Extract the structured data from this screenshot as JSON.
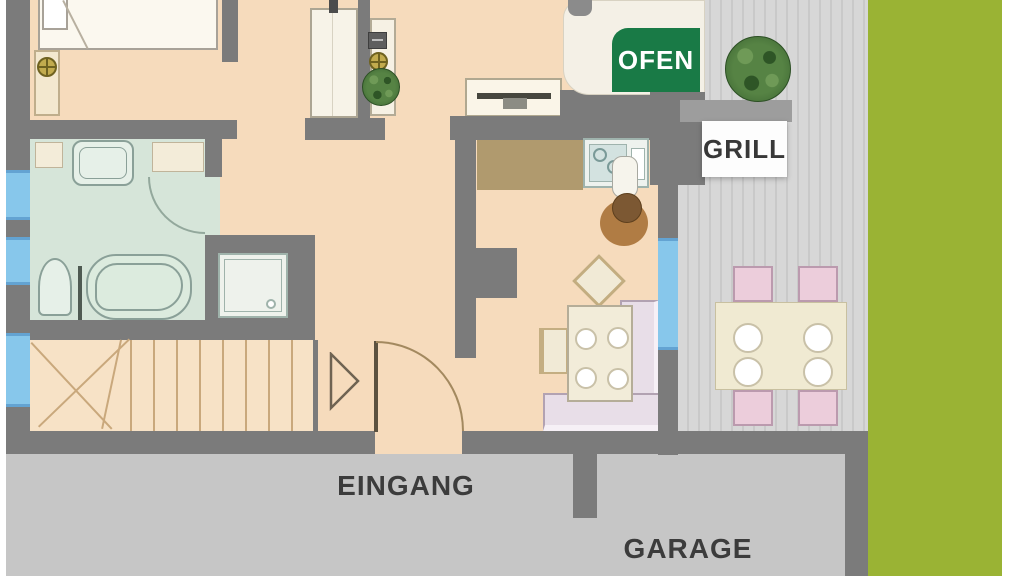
{
  "plan": {
    "type": "floor-plan",
    "labels": {
      "oven": "OFEN",
      "grill": "GRILL",
      "entrance": "EINGANG",
      "garage": "GARAGE"
    },
    "colors": {
      "wall": "#7b7b7b",
      "interior_floor": "#f6dbbc",
      "stairs_floor": "#f7e2c6",
      "bathroom_floor": "#d6e5d9",
      "window": "#87c7eb",
      "kitchen_counter": "#b09a6e",
      "terrace": "#d7d7d7",
      "outside_ground": "#c6c6c6",
      "lawn": "#9ab334",
      "oven_label_bg": "#197a46",
      "oven_label_text": "#ffffff",
      "grill_label_bg": "#ffffff",
      "grill_label_text": "#383838",
      "outside_label_text": "#3c3c3c",
      "dining_bench": "#e8dee8",
      "terrace_chair": "#eccddb",
      "plant": "#3f6d33"
    }
  }
}
